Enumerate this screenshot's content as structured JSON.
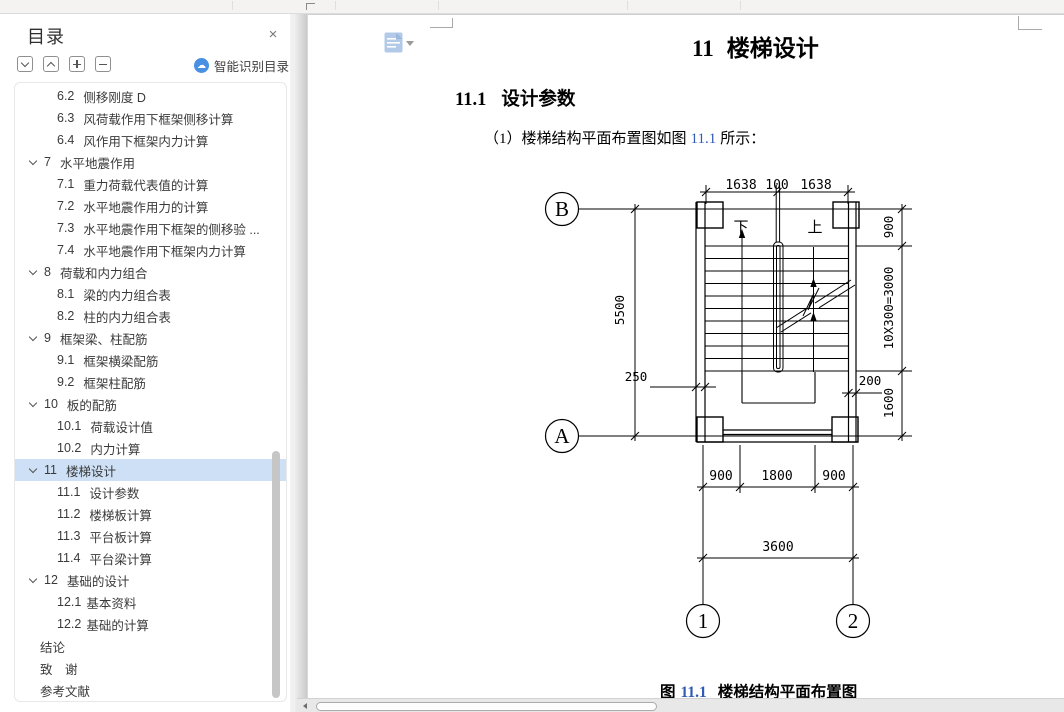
{
  "colors": {
    "link_blue": "#2f5bb7",
    "selection_blue": "#cde0f5",
    "smart_icon_blue": "#4a90e2",
    "chapter_icon_blue": "#b3c9e8"
  },
  "sidebar": {
    "title": "目录",
    "close_icon": "×",
    "smart_button_label": "智能识别目录",
    "items": [
      {
        "num": "6.2",
        "label": "侧移刚度 D",
        "level": 2
      },
      {
        "num": "6.3",
        "label": "风荷载作用下框架侧移计算",
        "level": 2
      },
      {
        "num": "6.4",
        "label": "风作用下框架内力计算",
        "level": 2
      },
      {
        "num": "7",
        "label": "水平地震作用",
        "level": 1,
        "caret": true
      },
      {
        "num": "7.1",
        "label": "重力荷载代表值的计算",
        "level": 2
      },
      {
        "num": "7.2",
        "label": "水平地震作用力的计算",
        "level": 2
      },
      {
        "num": "7.3",
        "label": "水平地震作用下框架的侧移验 ...",
        "level": 2
      },
      {
        "num": "7.4",
        "label": "水平地震作用下框架内力计算",
        "level": 2
      },
      {
        "num": "8",
        "label": "荷载和内力组合",
        "level": 1,
        "caret": true
      },
      {
        "num": "8.1",
        "label": "梁的内力组合表",
        "level": 2
      },
      {
        "num": "8.2",
        "label": "柱的内力组合表",
        "level": 2
      },
      {
        "num": "9",
        "label": "框架梁、柱配筋",
        "level": 1,
        "caret": true
      },
      {
        "num": "9.1",
        "label": "框架横梁配筋",
        "level": 2
      },
      {
        "num": "9.2",
        "label": "框架柱配筋",
        "level": 2
      },
      {
        "num": "10",
        "label": "板的配筋",
        "level": 1,
        "caret": true
      },
      {
        "num": "10.1",
        "label": "荷载设计值",
        "level": 2
      },
      {
        "num": "10.2",
        "label": "内力计算",
        "level": 2
      },
      {
        "num": "11",
        "label": "楼梯设计",
        "level": 1,
        "caret": true,
        "selected": true
      },
      {
        "num": "11.1",
        "label": "设计参数",
        "level": 2
      },
      {
        "num": "11.2",
        "label": "楼梯板计算",
        "level": 2
      },
      {
        "num": "11.3",
        "label": "平台板计算",
        "level": 2
      },
      {
        "num": "11.4",
        "label": "平台梁计算",
        "level": 2
      },
      {
        "num": "12",
        "label": "基础的设计",
        "level": 1,
        "caret": true
      },
      {
        "num": "12.1",
        "label": "基本资料",
        "level": 2,
        "tight": true
      },
      {
        "num": "12.2",
        "label": "基础的计算",
        "level": 2,
        "tight": true
      },
      {
        "num": "",
        "label": "结论",
        "level": 0
      },
      {
        "num": "",
        "label": "致　谢",
        "level": 0
      },
      {
        "num": "",
        "label": "参考文献",
        "level": 0
      }
    ]
  },
  "document": {
    "chapter_title": {
      "num": "11",
      "text": "楼梯设计"
    },
    "section_heading": {
      "num": "11.1",
      "text": "设计参数"
    },
    "paragraph": {
      "prefix": "（1）楼梯结构平面布置图如图",
      "link": "11.1",
      "suffix": "所示："
    },
    "caption": {
      "prefix": "图",
      "link": "11.1",
      "text": "楼梯结构平面布置图"
    }
  },
  "drawing": {
    "axis_labels": {
      "top_left": "B",
      "bottom_left": "A",
      "col_1": "1",
      "col_2": "2"
    },
    "direction": {
      "down": "下",
      "up": "上"
    },
    "top_dims": {
      "left": "1638",
      "mid": "100",
      "right": "1638"
    },
    "right_dims": {
      "d900": "900",
      "d3000": "10X300=3000",
      "d1600": "1600",
      "d200": "200"
    },
    "left_dims": {
      "d5500": "5500",
      "d250": "250"
    },
    "bottom_dims": {
      "left": "900",
      "mid": "1800",
      "right": "900",
      "total": "3600"
    }
  }
}
